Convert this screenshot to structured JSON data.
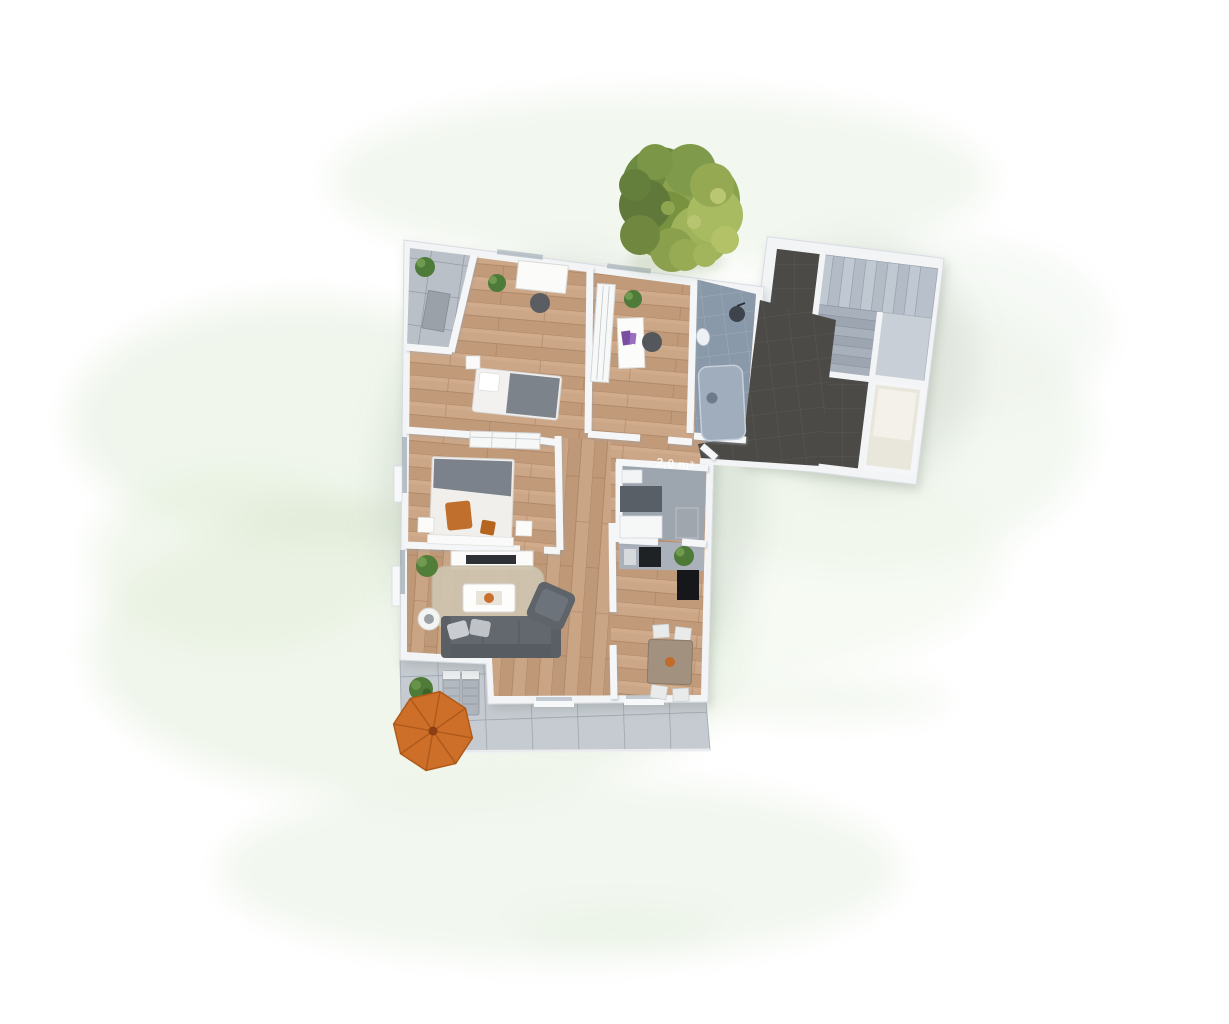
{
  "scene": {
    "type": "3d-apartment-floor-plan-render",
    "labels": {
      "storage_area": "2,0 m²"
    },
    "background": {
      "color": "#ffffff",
      "watercolor_wash": "#e6f0e0"
    },
    "colors": {
      "wood_floor": "#c7a081",
      "wall_white": "#f2f4f6",
      "terrace_tile": "#c6cbd2",
      "balcony_tile": "#b9c0c8",
      "bathroom_tile": "#8a99a9",
      "entry_tile_dark": "#4b4a47",
      "stair_tread": "#bfc7d1",
      "sofa_gray": "#62686e",
      "rug_beige": "#cfc5b0",
      "parasol_orange": "#cd6f28",
      "accent_orange": "#c06f2d",
      "tree_green_dark": "#66833f",
      "tree_green_light": "#a3b75c",
      "plant_green": "#4e7a3a"
    },
    "rooms": [
      {
        "id": "balcony",
        "floor": "gray-tile"
      },
      {
        "id": "bedroom",
        "floor": "wood"
      },
      {
        "id": "study",
        "floor": "wood"
      },
      {
        "id": "bathroom",
        "floor": "blue-gray-tile"
      },
      {
        "id": "hallway",
        "floor": "wood"
      },
      {
        "id": "storage",
        "floor": "gray"
      },
      {
        "id": "master-bedroom",
        "floor": "wood"
      },
      {
        "id": "living-room",
        "floor": "wood"
      },
      {
        "id": "kitchen",
        "floor": "wood"
      },
      {
        "id": "dining-area",
        "floor": "wood"
      },
      {
        "id": "terrace",
        "floor": "gray-tile"
      },
      {
        "id": "entrance-hall",
        "floor": "dark-tile"
      },
      {
        "id": "stairwell",
        "floor": "stairs"
      }
    ],
    "exterior": {
      "tree": "green-canopy-top-view",
      "parasol": "orange-octagon"
    }
  }
}
